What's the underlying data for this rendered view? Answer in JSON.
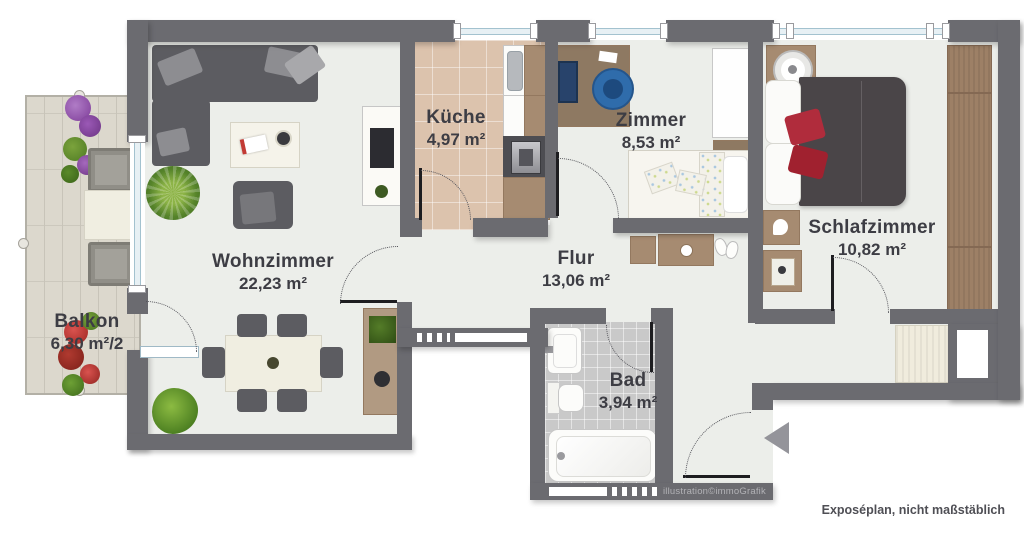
{
  "title": "Wohnungsgrundriss",
  "rooms": [
    {
      "name": "Balkon",
      "area": "6,30 m²/2"
    },
    {
      "name": "Wohnzimmer",
      "area": "22,23 m²"
    },
    {
      "name": "Küche",
      "area": "4,97 m²"
    },
    {
      "name": "Zimmer",
      "area": "8,53 m²"
    },
    {
      "name": "Flur",
      "area": "13,06 m²"
    },
    {
      "name": "Bad",
      "area": "3,94 m²"
    },
    {
      "name": "Schlafzimmer",
      "area": "10,82 m²"
    }
  ],
  "credits": {
    "watermark": "illustration©immoGrafik",
    "disclaimer": "Exposéplan, nicht maßstäblich"
  },
  "colors": {
    "wall": "#6b6b70",
    "floor": "#eceeea",
    "kitchen_floor": "#dcc3ad",
    "bath_floor": "#c9c9c9",
    "balcony_floor": "#dcd8cd",
    "window_glass": "#e7f0f4",
    "window_frame": "#a3c2cf",
    "accent_red_pillow": "#b02c3c",
    "office_chair_blue": "#2f6cab",
    "label_text": "#3d3d44"
  }
}
